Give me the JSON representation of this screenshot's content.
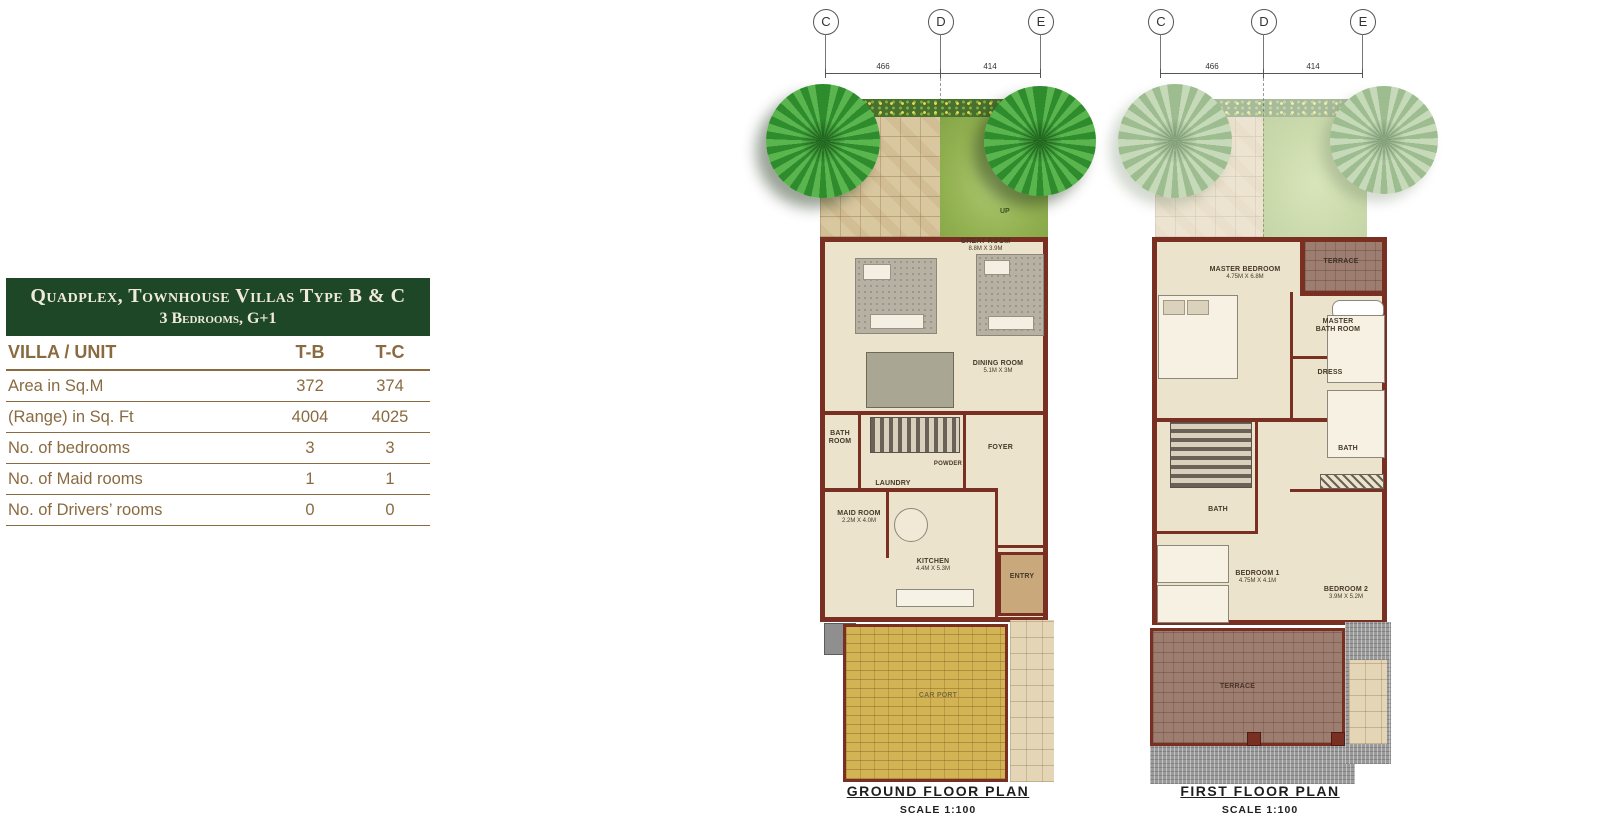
{
  "table": {
    "title_line1": "Quadplex, Townhouse Villas Type B & C",
    "title_line2": "3 Bedrooms, G+1",
    "header": {
      "label": "VILLA / UNIT",
      "col1": "T-B",
      "col2": "T-C"
    },
    "rows": [
      {
        "label": "Area in Sq.M",
        "tb": "372",
        "tc": "374"
      },
      {
        "label": "(Range) in Sq. Ft",
        "tb": "4004",
        "tc": "4025"
      },
      {
        "label": "No. of bedrooms",
        "tb": "3",
        "tc": "3"
      },
      {
        "label": "No. of Maid rooms",
        "tb": "1",
        "tc": "1"
      },
      {
        "label": "No. of Drivers’ rooms",
        "tb": "0",
        "tc": "0"
      }
    ]
  },
  "plans": {
    "ground": {
      "grid": [
        "C",
        "D",
        "E"
      ],
      "dims": [
        "466",
        "414"
      ],
      "rooms": {
        "great_room": {
          "name": "GREAT ROOM",
          "size": "8.8m x 3.9m"
        },
        "dining": {
          "name": "DINING ROOM",
          "size": "5.1m x 3m"
        },
        "bath": {
          "name": "BATH ROOM"
        },
        "laundry": {
          "name": "LAUNDRY"
        },
        "powder": {
          "name": "POWDER"
        },
        "foyer": {
          "name": "FOYER"
        },
        "maid": {
          "name": "MAID ROOM",
          "size": "2.2m x 4.0m"
        },
        "kitchen": {
          "name": "KITCHEN",
          "size": "4.4m x 5.3m"
        },
        "entry": {
          "name": "ENTRY"
        },
        "pump": {
          "name": "PUMP"
        },
        "carport": {
          "name": "CAR PORT"
        },
        "up": "UP"
      },
      "caption": "GROUND FLOOR PLAN",
      "scale": "SCALE 1:100"
    },
    "first": {
      "grid": [
        "C",
        "D",
        "E"
      ],
      "dims": [
        "466",
        "414"
      ],
      "rooms": {
        "master_bedroom": {
          "name": "MASTER BEDROOM",
          "size": "4.75m x 6.8m"
        },
        "terrace_top": {
          "name": "TERRACE"
        },
        "master_bath": {
          "name": "MASTER BATH ROOM"
        },
        "dress": {
          "name": "DRESS"
        },
        "bath_right": {
          "name": "BATH"
        },
        "bath_left": {
          "name": "BATH"
        },
        "bedroom1": {
          "name": "BEDROOM 1",
          "size": "4.75m x 4.1m"
        },
        "bedroom2": {
          "name": "BEDROOM 2",
          "size": "3.9m x 5.2m"
        },
        "terrace_bottom": {
          "name": "TERRACE"
        }
      },
      "caption": "FIRST FLOOR PLAN",
      "scale": "SCALE 1:100"
    }
  },
  "colors": {
    "header_green": "#1d4727",
    "table_text_brown": "#8a6b41",
    "wall_maroon": "#7a2f23",
    "floor_cream": "#ece3cc",
    "lawn_green": "#93b251",
    "carport_yellow": "#d3b455",
    "terrace_mauve": "#9c7d6f",
    "tree_green": "#3da13c"
  }
}
